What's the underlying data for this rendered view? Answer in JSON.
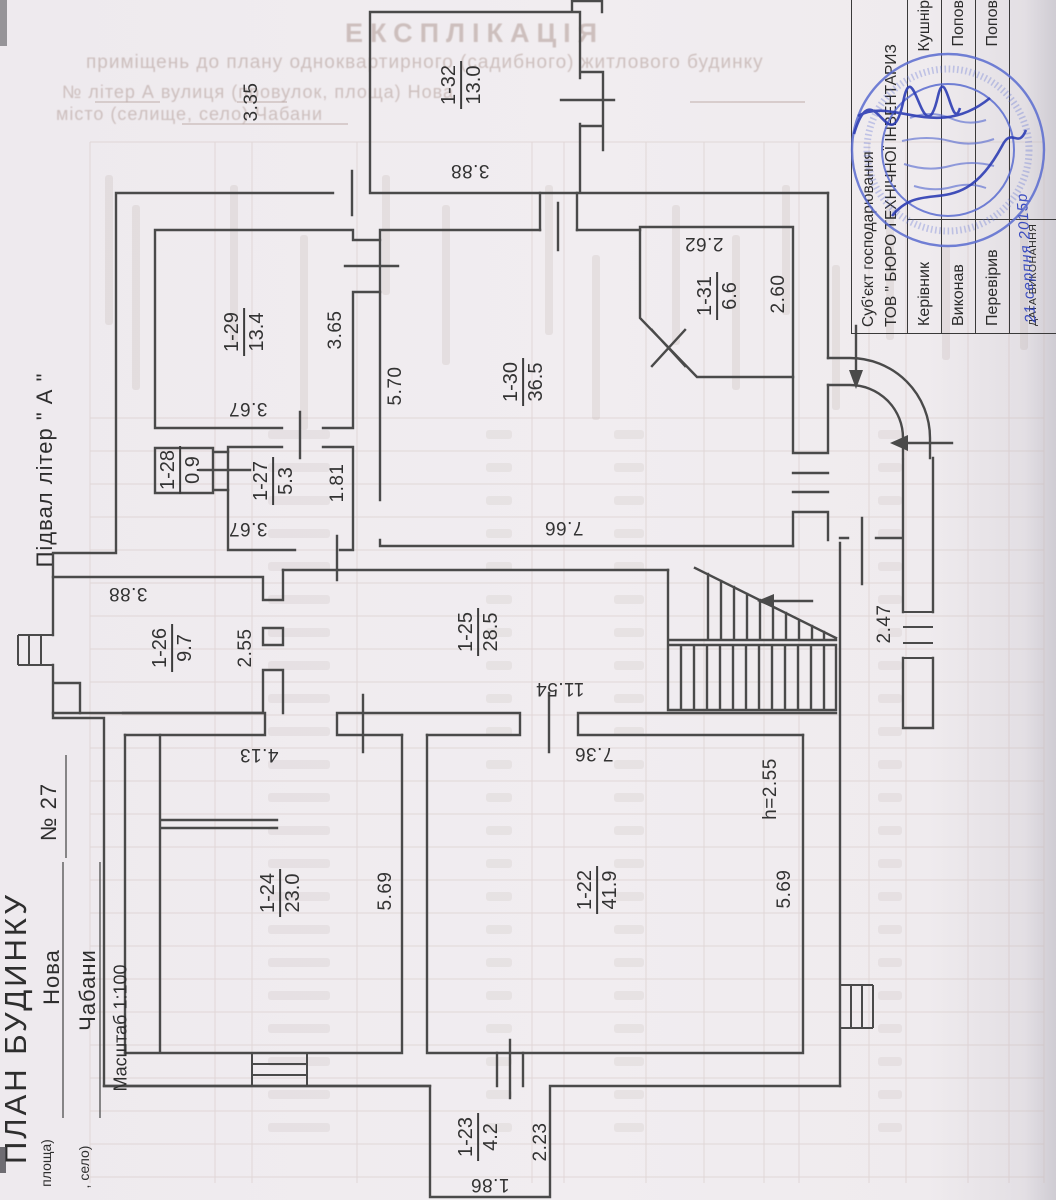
{
  "document": {
    "plan_title": "ПЛАН БУДИНКУ",
    "plan_subtitle": "Підвал  літер \" А \"",
    "house_number": "№    27",
    "street_name": "Нова",
    "street_caption": "площа)",
    "settlement_name": "Чабани",
    "settlement_caption": ", село)",
    "scale_label": "Масштаб 1:100"
  },
  "bleed_through": {
    "title": "ЕКСПЛІКАЦІЯ",
    "subtitle": "приміщень до плану одноквартирного (садибного) житлового будинку",
    "form_line1": "№            літер     А             вулиця (провулок, площа)      Нова",
    "form_line2": "місто (селище, село)      Чабани"
  },
  "doc_table": {
    "org_line1": "Суб'єкт господарювання",
    "org_line2": "ТОВ \" БЮРО ТЕХНІЧНОЇ ІНВЕНТАРИЗ",
    "rows": [
      {
        "label": "Керівник",
        "value": "Кушнір"
      },
      {
        "label": "Виконав",
        "value": "Попов"
      },
      {
        "label": "Перевірив",
        "value": "Попов"
      }
    ],
    "date_label": "ДАТА ВИКОНАННЯ",
    "date_value": "21 серпня 2015р"
  },
  "plan": {
    "rooms": [
      {
        "number": "1-32",
        "area": "13.0",
        "x": 462,
        "y": 85
      },
      {
        "number": "1-29",
        "area": "13.4",
        "x": 245,
        "y": 332
      },
      {
        "number": "1-28",
        "area": "0.9",
        "x": 181,
        "y": 470
      },
      {
        "number": "1-27",
        "area": "5.3",
        "x": 274,
        "y": 481
      },
      {
        "number": "1-30",
        "area": "36.5",
        "x": 524,
        "y": 382
      },
      {
        "number": "1-31",
        "area": "6.6",
        "x": 718,
        "y": 296
      },
      {
        "number": "1-26",
        "area": "9.7",
        "x": 173,
        "y": 648
      },
      {
        "number": "1-25",
        "area": "28.5",
        "x": 479,
        "y": 632
      },
      {
        "number": "1-24",
        "area": "23.0",
        "x": 281,
        "y": 893
      },
      {
        "number": "1-22",
        "area": "41.9",
        "x": 598,
        "y": 890
      },
      {
        "number": "1-23",
        "area": "4.2",
        "x": 479,
        "y": 1137
      }
    ],
    "dimensions": [
      {
        "t": "3.35",
        "x": 252,
        "y": 102,
        "r": -90
      },
      {
        "t": "3.88",
        "x": 470,
        "y": 170,
        "r": 180
      },
      {
        "t": "3.65",
        "x": 336,
        "y": 330,
        "r": -90
      },
      {
        "t": "5.70",
        "x": 396,
        "y": 386,
        "r": -90
      },
      {
        "t": "3.67",
        "x": 248,
        "y": 408,
        "r": 180
      },
      {
        "t": "1.81",
        "x": 338,
        "y": 483,
        "r": -90
      },
      {
        "t": "3.67",
        "x": 248,
        "y": 528,
        "r": 180
      },
      {
        "t": "7.66",
        "x": 564,
        "y": 527,
        "r": 180
      },
      {
        "t": "2.62",
        "x": 704,
        "y": 243,
        "r": 180
      },
      {
        "t": "2.60",
        "x": 779,
        "y": 294,
        "r": -90
      },
      {
        "t": "3.88",
        "x": 128,
        "y": 593,
        "r": 180
      },
      {
        "t": "2.55",
        "x": 246,
        "y": 648,
        "r": -90
      },
      {
        "t": "11.54",
        "x": 560,
        "y": 688,
        "r": 180
      },
      {
        "t": "7.36",
        "x": 594,
        "y": 753,
        "r": 180
      },
      {
        "t": "4.13",
        "x": 259,
        "y": 754,
        "r": 180
      },
      {
        "t": "5.69",
        "x": 386,
        "y": 891,
        "r": -90
      },
      {
        "t": "5.69",
        "x": 785,
        "y": 889,
        "r": -90
      },
      {
        "t": "h=2.55",
        "x": 771,
        "y": 789,
        "r": -90
      },
      {
        "t": "2.47",
        "x": 885,
        "y": 624,
        "r": -90
      },
      {
        "t": "2.23",
        "x": 541,
        "y": 1142,
        "r": -90
      },
      {
        "t": "1.86",
        "x": 490,
        "y": 1184,
        "r": 180
      }
    ]
  },
  "captions": [
    {
      "name": "plan-title",
      "bind": "document.plan_title",
      "x": 16,
      "y": 1028,
      "size": 31,
      "ls": 3
    },
    {
      "name": "plan-subtitle",
      "bind": "document.plan_subtitle",
      "x": 45,
      "y": 470,
      "size": 22,
      "ls": 1
    },
    {
      "name": "house-number",
      "bind": "document.house_number",
      "x": 49,
      "y": 812,
      "size": 22,
      "ls": 1
    },
    {
      "name": "street-name",
      "bind": "document.street_name",
      "x": 52,
      "y": 977,
      "size": 22,
      "ls": 1
    },
    {
      "name": "settlement-name",
      "bind": "document.settlement_name",
      "x": 88,
      "y": 990,
      "size": 22,
      "ls": 1
    },
    {
      "name": "scale-label",
      "bind": "document.scale_label",
      "x": 121,
      "y": 1028,
      "size": 18,
      "ls": 0
    },
    {
      "name": "street-caption",
      "bind": "document.street_caption",
      "x": 46,
      "y": 1163,
      "size": 14,
      "ls": 0
    },
    {
      "name": "settlement-caption",
      "bind": "document.settlement_caption",
      "x": 84,
      "y": 1167,
      "size": 14,
      "ls": 0
    }
  ],
  "colors": {
    "wall": "#4a4a4a",
    "stamp_blue": "#5a6cd0",
    "ink_blue": "#2e3eb4",
    "bleed": "#b09a94",
    "grid": "#cbb9b4"
  }
}
